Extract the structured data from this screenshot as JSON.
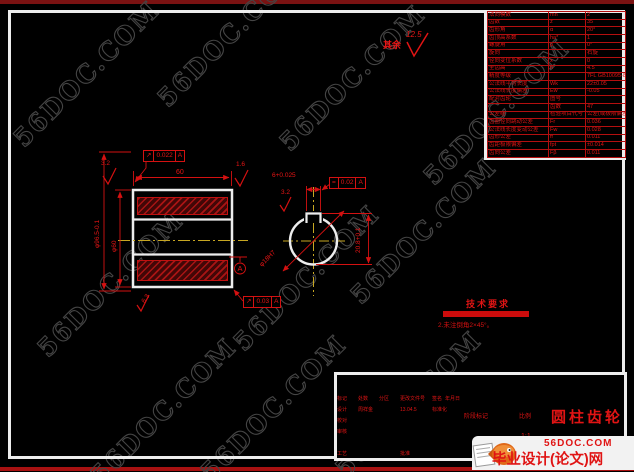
{
  "watermark": {
    "text": "56DOC.COM"
  },
  "site_banner": {
    "domain": "56DOC.COM",
    "site_name": "毕业设计(论文)网"
  },
  "general_note": {
    "prefix": "其余",
    "roughness": "12.5"
  },
  "tech_req": {
    "heading": "技术要求",
    "line1": "1.调质处理220～250HBS。",
    "line2": "2.未注倒角2×45°。"
  },
  "dimensions": {
    "face_width": "60",
    "outer_dia": "φ96.5-0.1",
    "hub_dia": "φ60",
    "rough_top_left": "3.2",
    "rough_top_right": "1.6",
    "rough_bottom": "6.3",
    "keyway_width": "6+0.025",
    "keyway_rough": "3.2",
    "keyway_depth": "20.8+0.1",
    "bore_dia": "φ18H7",
    "datum": "A"
  },
  "tolerances": {
    "top": {
      "sym": "↗",
      "val": "0.022",
      "ref": "A"
    },
    "bottom": {
      "sym": "↗",
      "val": "0.03",
      "ref": "A"
    },
    "keyway": {
      "sym": "=",
      "val": "0.02",
      "ref": "A"
    }
  },
  "gear_table": {
    "rows": [
      [
        "法向模数",
        "mn",
        "2"
      ],
      [
        "齿数",
        "z",
        "35"
      ],
      [
        "齿形角",
        "α",
        "20°"
      ],
      [
        "齿顶高系数",
        "ha*",
        "1"
      ],
      [
        "螺旋角",
        "β",
        "0°"
      ],
      [
        "旋向",
        "",
        "右旋"
      ],
      [
        "径向变位系数",
        "x",
        "0"
      ],
      [
        "全齿高",
        "h",
        "4.5"
      ],
      [
        "精度等级",
        "",
        "7FL GB10095-88"
      ],
      [
        "公法线平均长度",
        "Wk",
        "22±0.05"
      ],
      [
        "公法线长度偏差",
        "Ew",
        "-0.05"
      ],
      [
        "配对齿轮",
        "图号",
        ""
      ],
      [
        "",
        "齿数",
        "47"
      ],
      [
        "公差组",
        "检验项目代号",
        "公差(或极限偏差)值"
      ],
      [
        "齿圈径向跳动公差",
        "Fr",
        "0.036"
      ],
      [
        "公法线长度变动公差",
        "Fw",
        "0.028"
      ],
      [
        "齿形公差",
        "ff",
        "0.011"
      ],
      [
        "齿距极限偏差",
        "fpt",
        "±0.014"
      ],
      [
        "齿向公差",
        "Fβ",
        "0.011"
      ]
    ]
  },
  "title_block": {
    "title": "圆柱齿轮",
    "header": [
      "标记",
      "处数",
      "分区",
      "更改文件号",
      "签名",
      "年月日"
    ],
    "design_label": "设计",
    "designer": "周祥金",
    "date": "13.04.5",
    "std_label": "标准化",
    "check_label": "校对",
    "audit_label": "审核",
    "process_label": "工艺",
    "approve_label": "批准",
    "stage_label": "阶段标记",
    "scale_label": "比例",
    "scale_value": "1:1"
  }
}
